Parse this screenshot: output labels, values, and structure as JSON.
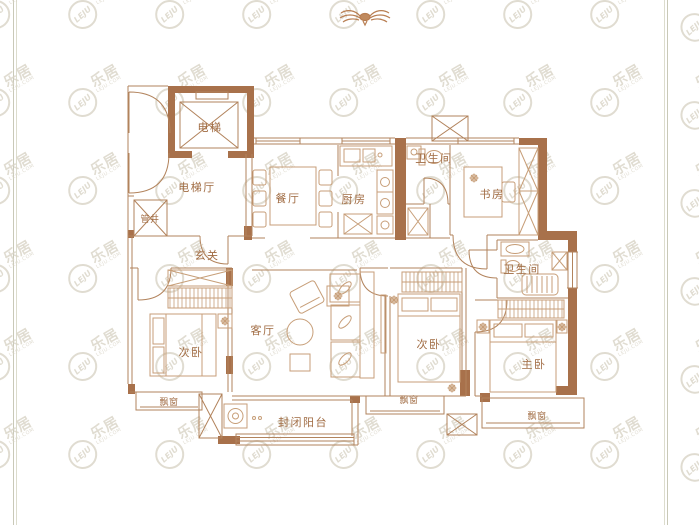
{
  "page": {
    "background": "#ffffff",
    "frame_color": "#c9c9b8"
  },
  "palette": {
    "wall_thick": "#a8714b",
    "wall_thin": "#b2835c",
    "furniture": "#c79e78",
    "label": "#a06b42",
    "watermark": "#d9d4c6"
  },
  "watermark": {
    "brand": "乐居",
    "logo": "LEJU",
    "domain": "LEJU.COM"
  },
  "compass": {
    "name": "north-indicator-emblem"
  },
  "rooms": [
    {
      "id": "elevator",
      "label": "电梯",
      "x": 210,
      "y": 131
    },
    {
      "id": "elevator-hall",
      "label": "电梯厅",
      "x": 197,
      "y": 191
    },
    {
      "id": "pipe-shaft",
      "label": "管井",
      "x": 150,
      "y": 221
    },
    {
      "id": "foyer",
      "label": "玄关",
      "x": 207,
      "y": 259
    },
    {
      "id": "dining",
      "label": "餐厅",
      "x": 288,
      "y": 202
    },
    {
      "id": "kitchen",
      "label": "厨房",
      "x": 354,
      "y": 203
    },
    {
      "id": "bath-top",
      "label": "卫生间",
      "x": 434,
      "y": 162
    },
    {
      "id": "study",
      "label": "书房",
      "x": 492,
      "y": 198
    },
    {
      "id": "living",
      "label": "客厅",
      "x": 263,
      "y": 334
    },
    {
      "id": "bedroom-left",
      "label": "次卧",
      "x": 191,
      "y": 356
    },
    {
      "id": "bedroom-mid",
      "label": "次卧",
      "x": 429,
      "y": 348
    },
    {
      "id": "master",
      "label": "主卧",
      "x": 534,
      "y": 368
    },
    {
      "id": "bath-right",
      "label": "卫生间",
      "x": 522,
      "y": 273
    },
    {
      "id": "bay-left",
      "label": "飘窗",
      "x": 169,
      "y": 404
    },
    {
      "id": "bay-mid",
      "label": "飘窗",
      "x": 409,
      "y": 402
    },
    {
      "id": "bay-master",
      "label": "飘窗",
      "x": 537,
      "y": 418
    },
    {
      "id": "balcony",
      "label": "封闭阳台",
      "x": 303,
      "y": 426
    }
  ]
}
